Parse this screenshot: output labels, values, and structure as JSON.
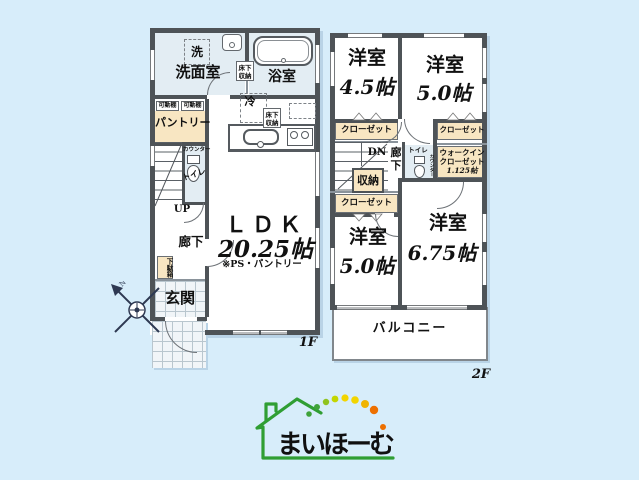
{
  "colors": {
    "background": "#d7edfa",
    "wall": "#4e5357",
    "closet_beige": "#f8e6c2",
    "wet_room_blue": "#e3edf3",
    "logo_green": "#2f9e33",
    "logo_text_color": "#101010",
    "logo_dots": [
      "#3fa33a",
      "#3fa33a",
      "#8fc31f",
      "#c3d600",
      "#f2d500",
      "#f2d500",
      "#f0b400",
      "#ed7000",
      "#ed7000"
    ]
  },
  "floor1": {
    "floor_label": "1F",
    "washroom": "洗面室",
    "laundry": "洗",
    "bathroom": "浴室",
    "underfloor_storage_a": "床下収納",
    "underfloor_storage_b": "床下収納",
    "fridge": "冷",
    "shelf_a": "可動棚",
    "shelf_b": "可動棚",
    "pantry": "パントリー",
    "counter": "カウンター",
    "toilet": "トイレ",
    "stairs_up": "UP",
    "hallway": "廊下",
    "shoe_cabinet": "下駄箱",
    "entrance": "玄関",
    "ldk_name": "ＬＤＫ",
    "ldk_size": "20.25帖",
    "ldk_note": "※PS・パントリー"
  },
  "floor2": {
    "floor_label": "2F",
    "room_nw_name": "洋室",
    "room_nw_size": "4.5帖",
    "room_ne_name": "洋室",
    "room_ne_size": "5.0帖",
    "room_sw_name": "洋室",
    "room_sw_size": "5.0帖",
    "room_se_name": "洋室",
    "room_se_size": "6.75帖",
    "closet_nw": "クローゼット",
    "closet_ne": "クローゼット",
    "closet_sw": "クローゼット",
    "walkin_line1": "ウォークイン",
    "walkin_line2": "クローゼット",
    "walkin_size": "1.125帖",
    "stairs_down": "DN",
    "hallway": "廊下",
    "storage": "収納",
    "toilet": "トイレ",
    "counter": "カウンター",
    "balcony": "バルコニー"
  },
  "compass": {
    "north_label": "N"
  },
  "logo": {
    "text": "まいほーむ"
  }
}
